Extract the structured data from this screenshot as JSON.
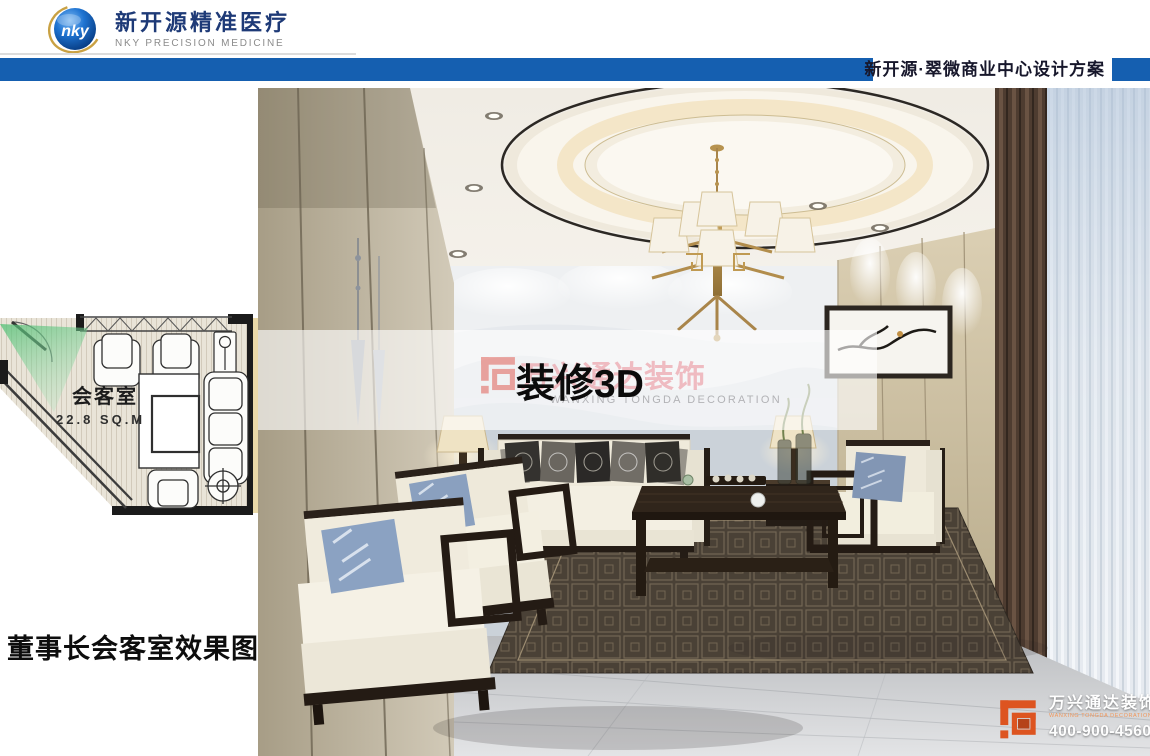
{
  "header": {
    "logo": {
      "acronym": "nky",
      "company_cn": "新开源精准医疗",
      "company_en": "NKY PRECISION MEDICINE"
    },
    "project_title": "新开源·翠微商业中心设计方案"
  },
  "floor_plan": {
    "room_name": "会客室",
    "room_area": "22.8 SQ.M"
  },
  "caption": "董事长会客室效果图",
  "watermark_overlay": {
    "title": "装修3D",
    "faint_company_cn": "万兴通达装饰",
    "faint_company_en": "WANXING TONGDA DECORATION"
  },
  "corner_watermark": {
    "company_cn": "万兴通达装饰",
    "company_en": "WANXING TONGDA DECORATION",
    "phone": "400-900-4560"
  },
  "colors": {
    "bar_blue": "#155fb0",
    "logo_navy": "#1e3a77",
    "watermark_orange": "#dd5420",
    "view_cone_green": "#66c583"
  }
}
